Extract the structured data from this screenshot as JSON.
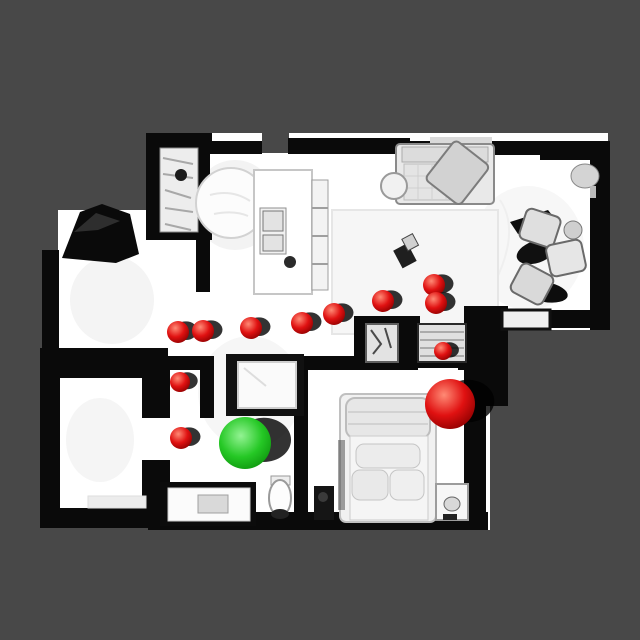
{
  "scene": {
    "description": "top-down orthographic view of a scanned apartment mesh with navigation markers",
    "palette": {
      "background": "#484848",
      "floor": "#ffffff",
      "walls": "#0a0a0a",
      "rug": "#f6f6f6",
      "furniture": "#e6e6e6",
      "red_sphere": {
        "highlight": "#ff8a75",
        "base": "#e01111",
        "edge": "#8f0000"
      },
      "green_sphere": {
        "highlight": "#93f393",
        "base": "#25c825",
        "edge": "#0b8f0b"
      },
      "shadow": "#000000"
    }
  },
  "markers": {
    "waypoints": [
      {
        "x": 178,
        "y": 332,
        "r": 11
      },
      {
        "x": 203,
        "y": 331,
        "r": 11
      },
      {
        "x": 251,
        "y": 328,
        "r": 11
      },
      {
        "x": 302,
        "y": 323,
        "r": 11
      },
      {
        "x": 334,
        "y": 314,
        "r": 11
      },
      {
        "x": 383,
        "y": 301,
        "r": 11
      },
      {
        "x": 434,
        "y": 285,
        "r": 11
      },
      {
        "x": 436,
        "y": 303,
        "r": 11
      },
      {
        "x": 443,
        "y": 351,
        "r": 9
      },
      {
        "x": 180,
        "y": 382,
        "r": 10
      },
      {
        "x": 181,
        "y": 438,
        "r": 11
      }
    ],
    "goal": {
      "x": 245,
      "y": 443,
      "r": 26
    },
    "target": {
      "x": 450,
      "y": 404,
      "r": 25
    }
  }
}
